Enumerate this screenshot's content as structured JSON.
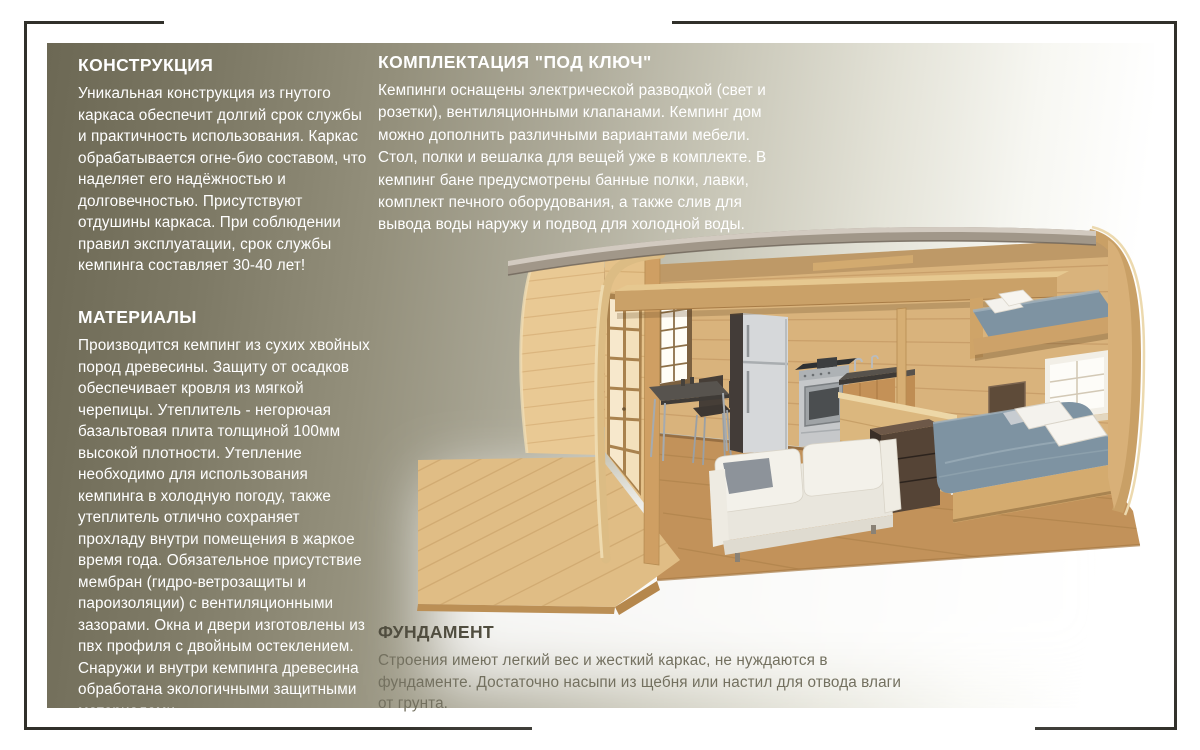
{
  "page": {
    "corner_frame_color": "#31302a",
    "panel": {
      "gradient_left": "#6c6854",
      "gradient_right": "#ffffff"
    },
    "text_color_light_sections": "#ffffff",
    "text_color_foundation": "#504d3f"
  },
  "sections": {
    "construction": {
      "title": "КОНСТРУКЦИЯ",
      "body": "Уникальная конструкция из гнутого каркаса обеспечит долгий срок службы и практичность использования. Каркас обрабатывается огне-био составом, что наделяет его надёжностью и долговечностью. Присутствуют отдушины каркаса. При соблюдении правил эксплуатации, срок службы кемпинга составляет 30-40 лет!"
    },
    "materials": {
      "title": "МАТЕРИАЛЫ",
      "body": "Производится кемпинг из сухих хвойных пород древесины. Защиту от осадков обеспечивает кровля из мягкой черепицы. Утеплитель - негорючая базальтовая плита толщиной 100мм высокой плотности. Утепление необходимо для использования кемпинга в холодную погоду, также утеплитель отлично сохраняет прохладу внутри помещения в жаркое время года. Обязательное присутствие мембран (гидро-ветрозащиты и пароизоляции) с вентиляционными зазорами. Окна и двери изготовлены из пвх профиля с двойным остеклением. Снаружи и внутри кемпинга древесина обработана экологичными защитными материалами."
    },
    "turnkey": {
      "title": "КОМПЛЕКТАЦИЯ \"ПОД КЛЮЧ\"",
      "body": "Кемпинги оснащены электрической разводкой (свет и розетки), вентиляционными клапанами. Кемпинг дом можно дополнить различными вариантами мебели. Стол, полки и вешалка для вещей уже в комплекте. В кемпинг бане предусмотрены банные полки, лавки, комплект печного оборудования, а также слив для вывода воды наружу и подвод для холодной воды."
    },
    "foundation": {
      "title": "ФУНДАМЕНТ",
      "body": "Строения имеют легкий вес и жесткий каркас, не нуждаются в фундаменте. Достаточно насыпи из щебня или настил для отвода влаги от грунта."
    }
  },
  "illustration": {
    "name": "camping-house-cutaway",
    "palette": {
      "wood_wall": "#d9b37c",
      "wood_floor": "#c2925a",
      "deck": "#e0bd85",
      "roof_fascia": "#a19789",
      "arch_rim": "#c9a066",
      "mattress": "#7e93a2",
      "pillow": "#f4f2ed",
      "fridge": "#d6d8da",
      "sofa": "#efece4",
      "dark_furniture": "#4a3a2e"
    }
  }
}
